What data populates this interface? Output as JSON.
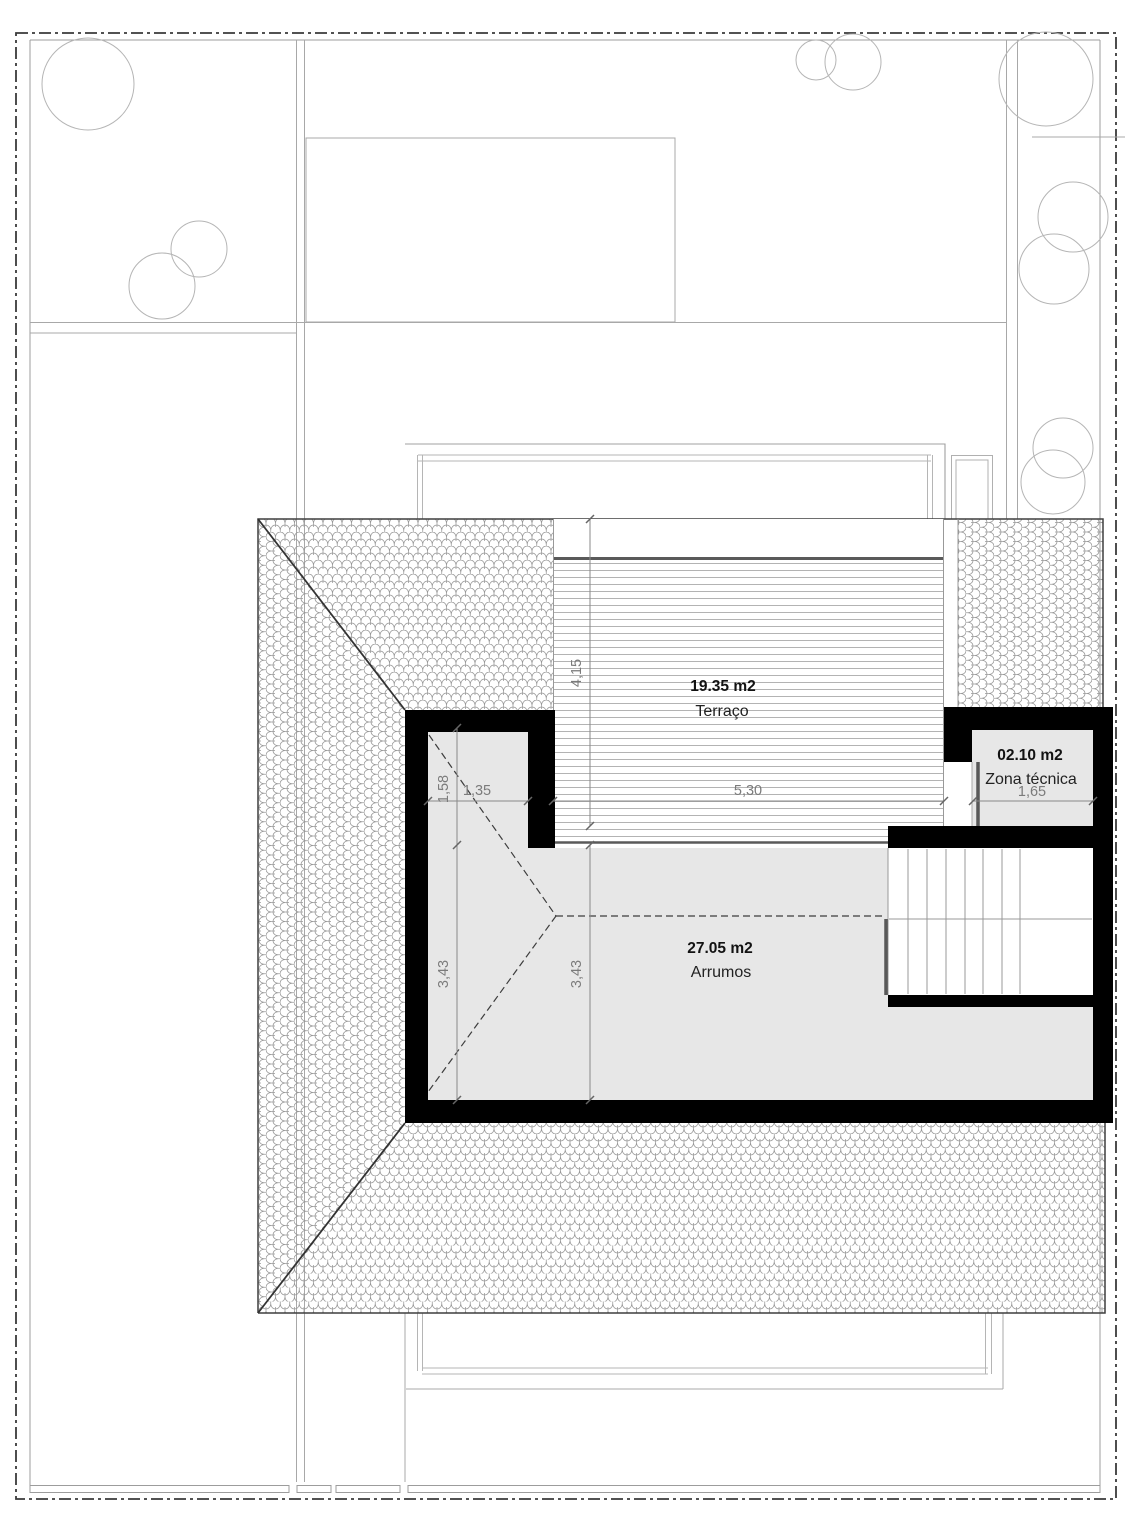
{
  "plan": {
    "rooms": [
      {
        "area": "19.35 m2",
        "name": "Terraço"
      },
      {
        "area": "02.10 m2",
        "name": "Zona técnica"
      },
      {
        "area": "27.05 m2",
        "name": "Arrumos"
      }
    ],
    "dimensions": {
      "corridor_height": "1,58",
      "corridor_width": "1,35",
      "terrace_height": "4,15",
      "terrace_width": "5,30",
      "zona_tecnica_width": "1,65",
      "storage_height_left": "3,43",
      "storage_height_right": "3,43"
    },
    "colors": {
      "wall": "#000000",
      "floor_gray": "#e7e7e7",
      "roof_line": "#3f3f3f",
      "tile_stroke": "#989898",
      "dimension_gray": "#7b7b7b",
      "label_dark": "#121212",
      "site_line": "#a8a8a8",
      "deck_edge": "#5a5a5a"
    }
  }
}
